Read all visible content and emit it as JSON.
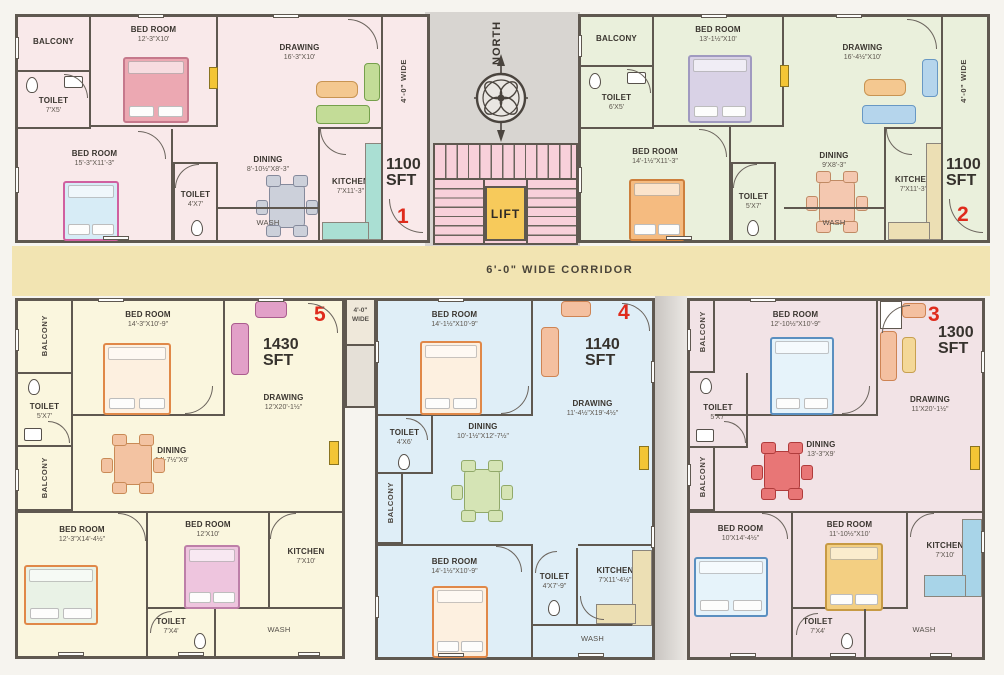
{
  "page": {
    "corridor_label": "6'-0\" WIDE  CORRIDOR",
    "north_label": "NORTH",
    "lift_label": "LIFT",
    "passage_line1": "4'-0\"",
    "passage_line2": "WIDE"
  },
  "colors": {
    "wall": "#5f5850",
    "unit1_bg": "#f9e9ea",
    "unit2_bg": "#eaf0dc",
    "unit3_bg": "#f2e3e6",
    "unit4_bg": "#dfeef7",
    "unit5_bg": "#faf6de",
    "corridor_bg": "#f2e4b2",
    "stair_bg": "#f8d0da",
    "lift_bg": "#f7ca5b",
    "unit_number_red": "#df2b1c"
  },
  "units": {
    "u1": {
      "number": "1",
      "area_value": "1100",
      "area_unit": "SFT",
      "side_label": "4'-0\"  WIDE",
      "rooms": {
        "balcony": {
          "name": "BALCONY"
        },
        "toilet1": {
          "name": "TOILET",
          "dims": "7'X5'"
        },
        "bedroom1": {
          "name": "BED ROOM",
          "dims": "12'-3\"X10'"
        },
        "drawing": {
          "name": "DRAWING",
          "dims": "16'-3\"X10'"
        },
        "bedroom2": {
          "name": "BED ROOM",
          "dims": "15'-3\"X11'-3\""
        },
        "dining": {
          "name": "DINING",
          "dims": "8'-10½\"X8'-3\""
        },
        "toilet2": {
          "name": "TOILET",
          "dims": "4'X7'"
        },
        "kitchen": {
          "name": "KITCHEN",
          "dims": "7'X11'-3\""
        },
        "wash": {
          "name": "WASH"
        }
      }
    },
    "u2": {
      "number": "2",
      "area_value": "1100",
      "area_unit": "SFT",
      "side_label": "4'-0\"  WIDE",
      "rooms": {
        "balcony": {
          "name": "BALCONY"
        },
        "toilet1": {
          "name": "TOILET",
          "dims": "6'X5'"
        },
        "bedroom1": {
          "name": "BED ROOM",
          "dims": "13'-1½\"X10'"
        },
        "drawing": {
          "name": "DRAWING",
          "dims": "16'-4½\"X10'"
        },
        "bedroom2": {
          "name": "BED ROOM",
          "dims": "14'-1½\"X11'-3\""
        },
        "dining": {
          "name": "DINING",
          "dims": "9'X8'-3\""
        },
        "toilet2": {
          "name": "TOILET",
          "dims": "5'X7'"
        },
        "kitchen": {
          "name": "KITCHEN",
          "dims": "7'X11'-3\""
        },
        "wash": {
          "name": "WASH"
        }
      }
    },
    "u5": {
      "number": "5",
      "area_value": "1430",
      "area_unit": "SFT",
      "rooms": {
        "balcony1": {
          "name": "BALCONY"
        },
        "toilet1": {
          "name": "TOILET",
          "dims": "5'X7'"
        },
        "balcony2": {
          "name": "BALCONY"
        },
        "bedroom1": {
          "name": "BED ROOM",
          "dims": "14'-3\"X10'-9\""
        },
        "drawing": {
          "name": "DRAWING",
          "dims": "12'X20'-1½\""
        },
        "dining": {
          "name": "DINING",
          "dims": "14'-7½\"X9'"
        },
        "bedroom2": {
          "name": "BED ROOM",
          "dims": "12'-3\"X14'-4½\""
        },
        "bedroom3": {
          "name": "BED ROOM",
          "dims": "12'X10'"
        },
        "kitchen": {
          "name": "KITCHEN",
          "dims": "7'X10'"
        },
        "toilet2": {
          "name": "TOILET",
          "dims": "7'X4'"
        },
        "wash": {
          "name": "WASH"
        }
      }
    },
    "u4": {
      "number": "4",
      "area_value": "1140",
      "area_unit": "SFT",
      "rooms": {
        "bedroom1": {
          "name": "BED ROOM",
          "dims": "14'-1½\"X10'-9\""
        },
        "drawing": {
          "name": "DRAWING",
          "dims": "11'-4½\"X19'-4½\""
        },
        "toilet1": {
          "name": "TOILET",
          "dims": "4'X6'"
        },
        "dining": {
          "name": "DINING",
          "dims": "10'-1½\"X12'-7½\""
        },
        "balcony": {
          "name": "BALCONY"
        },
        "bedroom2": {
          "name": "BED ROOM",
          "dims": "14'-1½\"X10'-9\""
        },
        "toilet2": {
          "name": "TOILET",
          "dims": "4'X7'-9\""
        },
        "kitchen": {
          "name": "KITCHEN",
          "dims": "7'X11'-4½\""
        },
        "wash": {
          "name": "WASH"
        }
      }
    },
    "u3": {
      "number": "3",
      "area_value": "1300",
      "area_unit": "SFT",
      "rooms": {
        "balcony1": {
          "name": "BALCONY"
        },
        "bedroom1": {
          "name": "BED ROOM",
          "dims": "12'-10½\"X10'-9\""
        },
        "drawing": {
          "name": "DRAWING",
          "dims": "11'X20'-1½\""
        },
        "toilet1": {
          "name": "TOILET",
          "dims": "5'X7'"
        },
        "balcony2": {
          "name": "BALCONY"
        },
        "dining": {
          "name": "DINING",
          "dims": "13'-3\"X9'"
        },
        "bedroom2": {
          "name": "BED ROOM",
          "dims": "10'X14'-4½\""
        },
        "bedroom3": {
          "name": "BED ROOM",
          "dims": "11'-10½\"X10'"
        },
        "kitchen": {
          "name": "KITCHEN",
          "dims": "7'X10'"
        },
        "toilet2": {
          "name": "TOILET",
          "dims": "7'X4'"
        },
        "wash": {
          "name": "WASH"
        }
      }
    }
  }
}
